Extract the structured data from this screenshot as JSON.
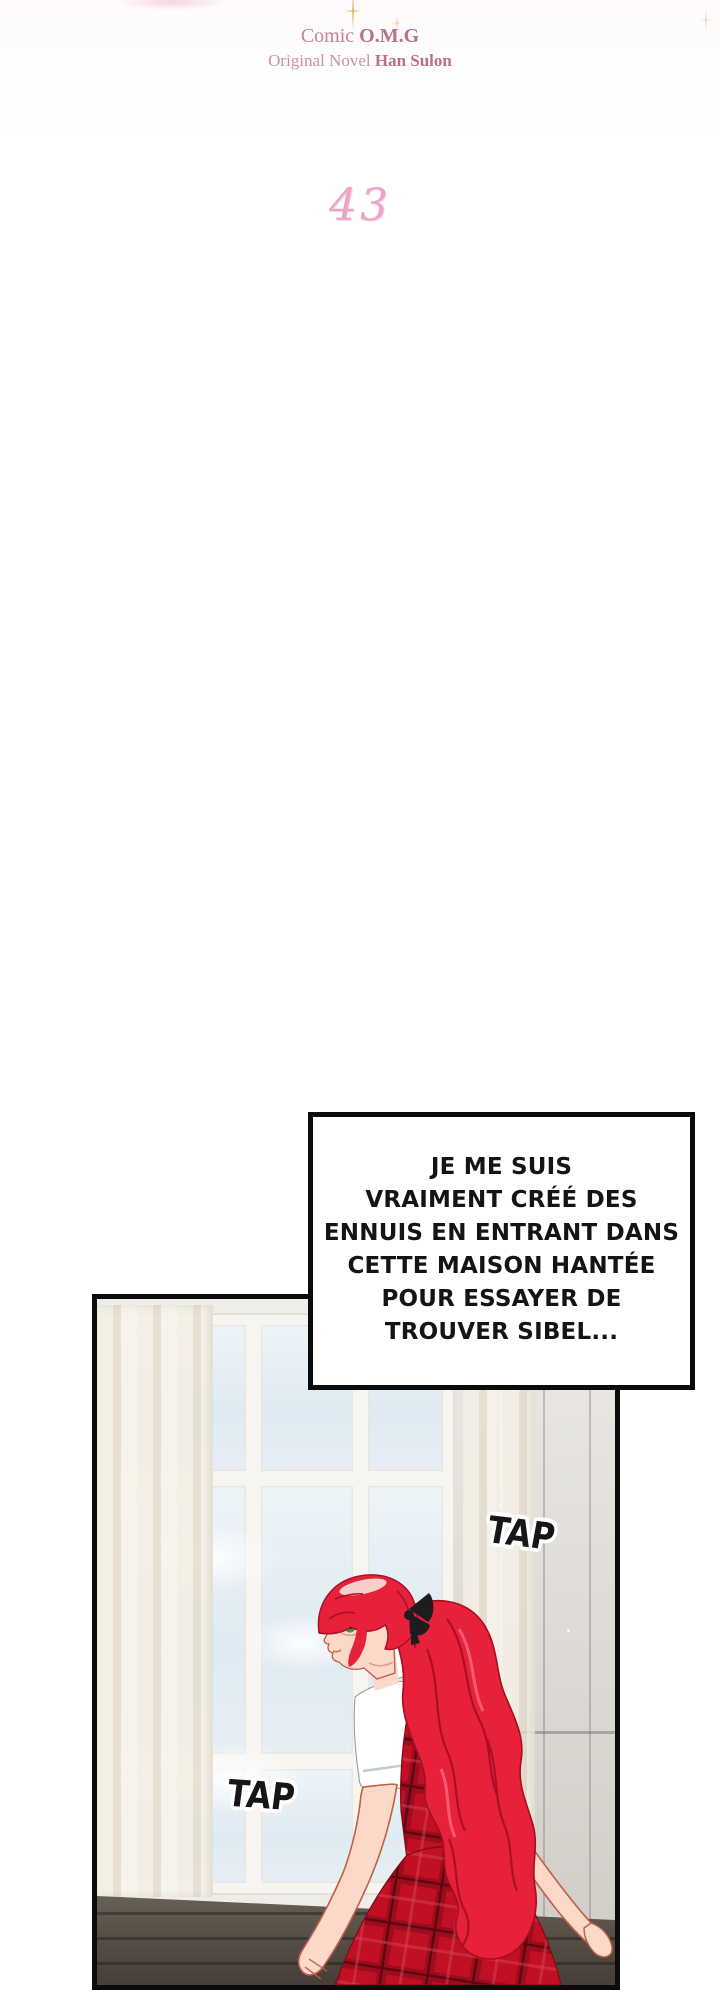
{
  "page": {
    "width": 720,
    "height": 2000,
    "background": "#ffffff"
  },
  "header": {
    "credit_line1": {
      "prefix": "Comic ",
      "strong": "O.M.G"
    },
    "credit_line2": {
      "prefix": "Original Novel ",
      "strong": "Han Sulon"
    },
    "chapter_number": "43"
  },
  "speech_bubble": {
    "lines": [
      "JE ME SUIS",
      "VRAIMENT CRÉÉ DES",
      "ENNUIS EN ENTRANT DANS",
      "CETTE MAISON HANTÉE",
      "POUR ESSAYER DE",
      "TROUVER SIBEL..."
    ]
  },
  "sfx": {
    "tap_upper": "TAP",
    "tap_lower": "TAP"
  },
  "colors": {
    "credits_pink": "#c5829e",
    "chapter_pink": "#eda4c6",
    "hair_red": "#e62139",
    "hair_shadow_red": "#a60e23",
    "hair_highlight": "#f6cfcb",
    "dress_red": "#c11023",
    "dress_plaid_dark": "#9c0c1d",
    "skin": "#fbd8c8",
    "sky_blue": "#e0eaf2",
    "sill_brown": "#5d554b",
    "bubble_border": "#0b0b0b",
    "eye_green": "#3f9152"
  }
}
